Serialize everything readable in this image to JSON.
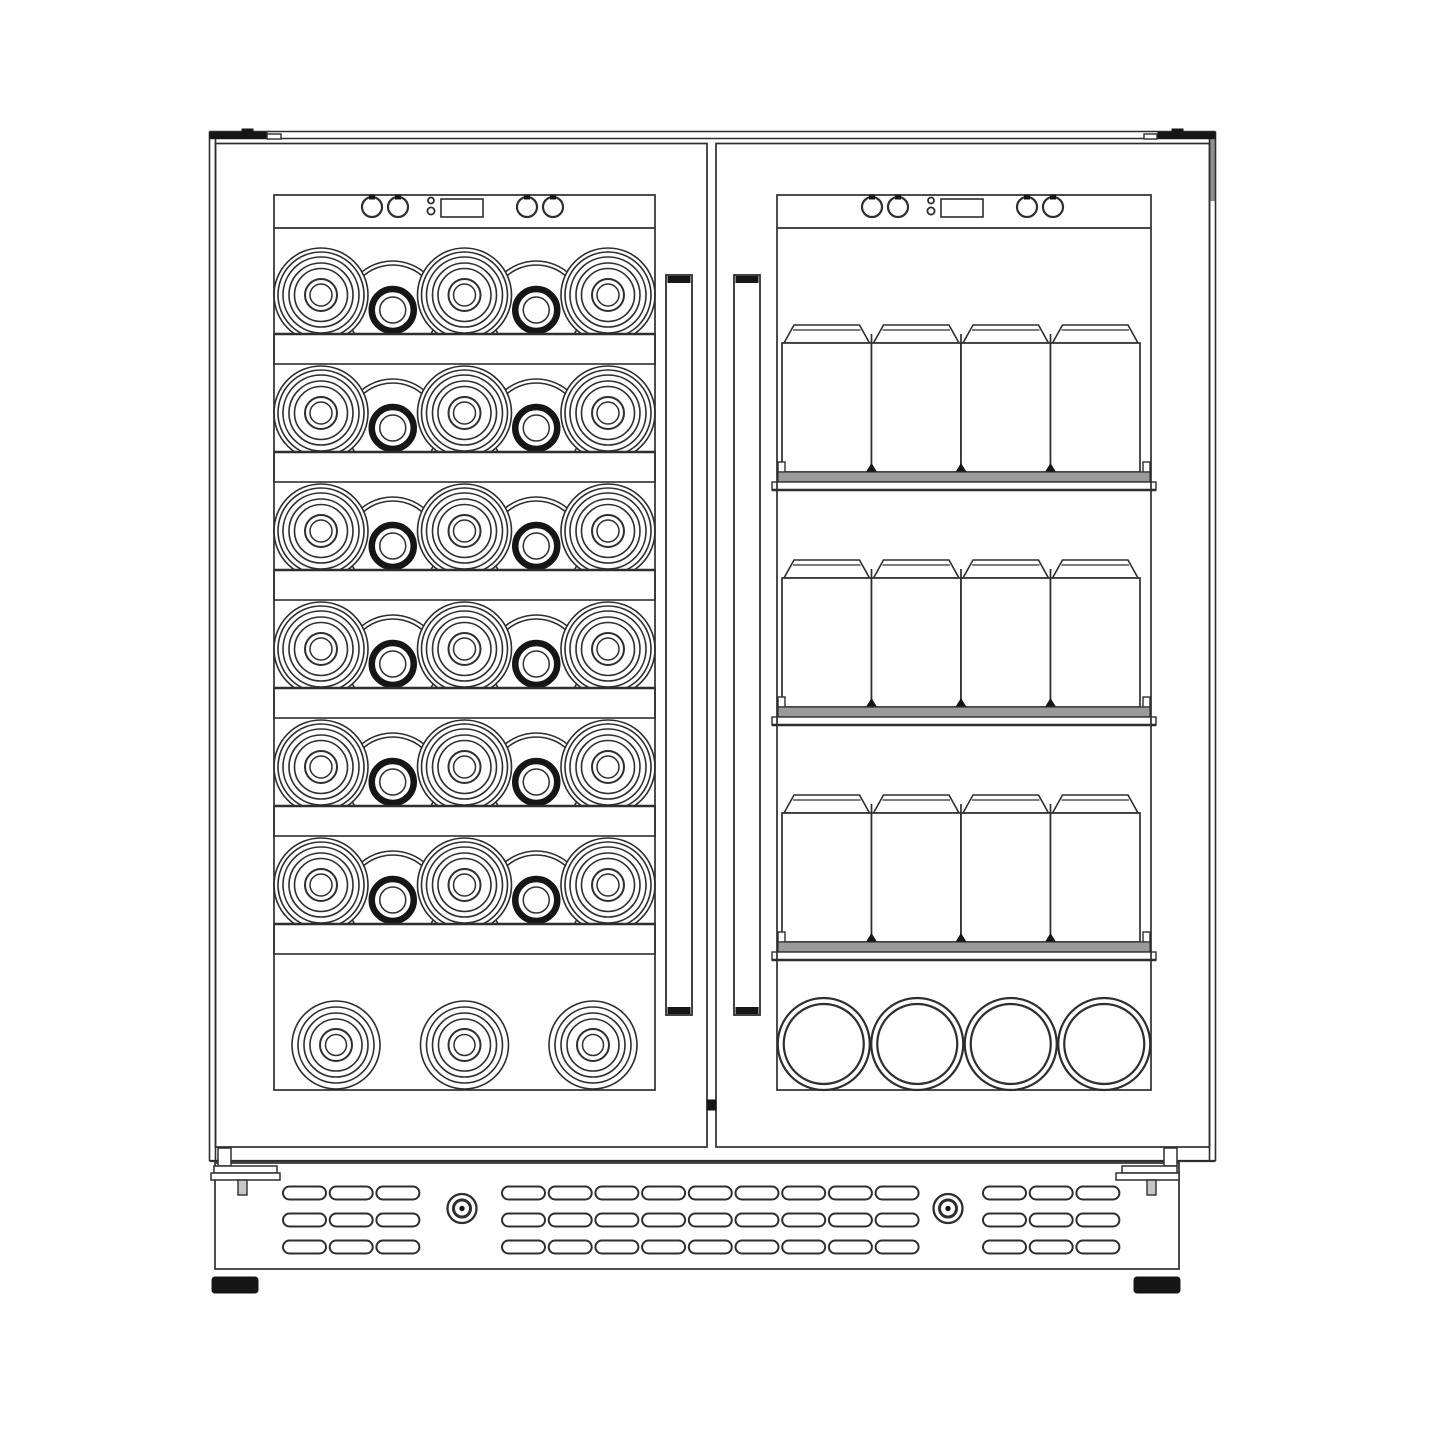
{
  "meta": {
    "subject": "front-view technical line drawing of a built-in French-door dual-zone wine and beverage cooler",
    "left_compartment": {
      "wine_shelf_rows": 6,
      "bottles_per_row": 5,
      "large_bottles_per_row": 3,
      "neck_bottles_per_row": 2,
      "bottom_bulk_bottles": 3
    },
    "right_compartment": {
      "can_shelf_rows": 3,
      "cans_per_row": 4,
      "bottom_lying_cans": 4
    },
    "doors": 2,
    "handles": 2,
    "control_panels": 2,
    "control_buttons_per_panel": 4,
    "vent_slot_groups": 3,
    "vent_rows": 3,
    "front_screws": 2,
    "feet": 2
  },
  "colors": {
    "line": "#2e2e2e",
    "dark": "#161616",
    "shelf_gray": "#9a9a9a",
    "shade": "#8f8f8f",
    "pin_gray": "#c6c6c6",
    "white": "#ffffff",
    "bg": "#ffffff"
  },
  "geometry": {
    "canvas": {
      "w": 1445,
      "h": 1445
    },
    "cabinet": {
      "top_line1": 131.5,
      "top_line2": 138.5,
      "left_out": 209.5,
      "left_in": 215.5,
      "right_in": 1209.5,
      "right_out": 1215.5,
      "door_top": 143.5,
      "door_bottom": 1147,
      "base_line": 1161,
      "shade_y2": 201,
      "kick": {
        "x1": 215,
        "x2": 1179,
        "y1": 1163,
        "y2": 1269
      }
    },
    "hinges": {
      "y": 132.5,
      "h": 6,
      "tab_h": 3.5,
      "tab_w": 11,
      "notch_y1": 134,
      "notch_y2": 139,
      "left": {
        "bar_x1": 210,
        "bar_x2": 267,
        "tab_x": 242,
        "notch_x1": 267,
        "notch_x2": 281
      },
      "right": {
        "bar_x1": 1158,
        "bar_x2": 1215,
        "tab_x": 1172,
        "notch_x1": 1144,
        "notch_x2": 1157
      }
    },
    "doors": {
      "gap_x1": 707,
      "gap_x2": 716,
      "latch": {
        "y1": 1100,
        "y2": 1110
      },
      "left": {
        "x1": 215.5,
        "x2": 707,
        "win": {
          "x1": 274,
          "y1": 195,
          "x2": 655,
          "y2": 1090
        },
        "strip_y": 228,
        "handle": {
          "x": 666,
          "w": 26,
          "y1": 275,
          "y2": 1015,
          "cap": 7
        },
        "panel_dx": 0
      },
      "right": {
        "x1": 716,
        "x2": 1209.5,
        "win": {
          "x1": 777,
          "y1": 195,
          "x2": 1151,
          "y2": 1090
        },
        "strip_y": 228,
        "handle": {
          "x": 734,
          "w": 26,
          "y1": 275,
          "y2": 1015,
          "cap": 7
        },
        "panel_dx": 500
      }
    },
    "panel": {
      "btn_cy": 207,
      "btn_r": 10,
      "buttons": [
        372,
        398,
        527,
        553
      ],
      "dots": [
        {
          "cx": 431,
          "cy": 200.5,
          "r": 3
        },
        {
          "cx": 431,
          "cy": 211,
          "r": 3.6
        }
      ],
      "display": {
        "x": 441,
        "y": 199,
        "w": 42,
        "h": 18
      }
    },
    "wine": {
      "shelf_tops": [
        334,
        452,
        570,
        688,
        806,
        924
      ],
      "shelf_h": 30,
      "big_x": [
        321,
        464.5,
        608
      ],
      "big_dy": 39,
      "big_rings": [
        47,
        43,
        38,
        32,
        26.5
      ],
      "big_inner": [
        16,
        11
      ],
      "neck_x": [
        392.75,
        536.25
      ],
      "neck_dy": 24,
      "shoulder_rings": [
        49,
        45
      ],
      "neck_r": 21,
      "neck_stroke": 6.5,
      "neck_inner_r": 13,
      "bottom": {
        "x": [
          336,
          464.5,
          593
        ],
        "cy": 1045,
        "rings": [
          44,
          38,
          32,
          26
        ],
        "inner": [
          16,
          10.5
        ]
      }
    },
    "cans": {
      "row_tops": [
        325,
        560,
        795
      ],
      "x1": 782,
      "x2": 1140,
      "count": 4,
      "lid_h": 18,
      "lid_line": 5,
      "lid_inset": 12,
      "body_h": 129,
      "shelf": {
        "gray_x1": 778,
        "gray_x2": 1150,
        "gray_h": 10,
        "lip_x1": 772,
        "lip_x2": 1156,
        "lip_h": 8
      },
      "clip_w": 7,
      "clip_h": 10,
      "bottom": {
        "x": [
          823.75,
          917.25,
          1010.75,
          1104.25
        ],
        "cy": 1044,
        "rings": [
          46,
          40
        ]
      }
    },
    "vents": {
      "rows_y": [
        1186.5,
        1213.5,
        1240.5
      ],
      "slot_h": 13,
      "slot_w": 43,
      "pitch": 46.7,
      "groups": [
        {
          "x": 283,
          "n": 3
        },
        {
          "x": 502,
          "n": 9
        },
        {
          "x": 983,
          "n": 3
        }
      ],
      "screws": [
        {
          "cx": 462,
          "cy": 1208.5
        },
        {
          "cx": 948,
          "cy": 1208.5
        }
      ]
    },
    "base": {
      "brackets": {
        "left": {
          "vert": [
            218,
            1148,
            13,
            18
          ],
          "plate1": [
            214,
            1166,
            63,
            7
          ],
          "plate2": [
            211,
            1173,
            69,
            7
          ],
          "pin": [
            238,
            1180,
            9,
            15
          ]
        },
        "right": {
          "vert": [
            1164,
            1148,
            13,
            18
          ],
          "plate1": [
            1122,
            1166,
            55,
            7
          ],
          "plate2": [
            1116,
            1173,
            63,
            7
          ],
          "pin": [
            1147,
            1180,
            9,
            15
          ]
        }
      },
      "feet": [
        [
          212,
          1277,
          46,
          16
        ],
        [
          1134,
          1277,
          46,
          16
        ]
      ]
    }
  }
}
